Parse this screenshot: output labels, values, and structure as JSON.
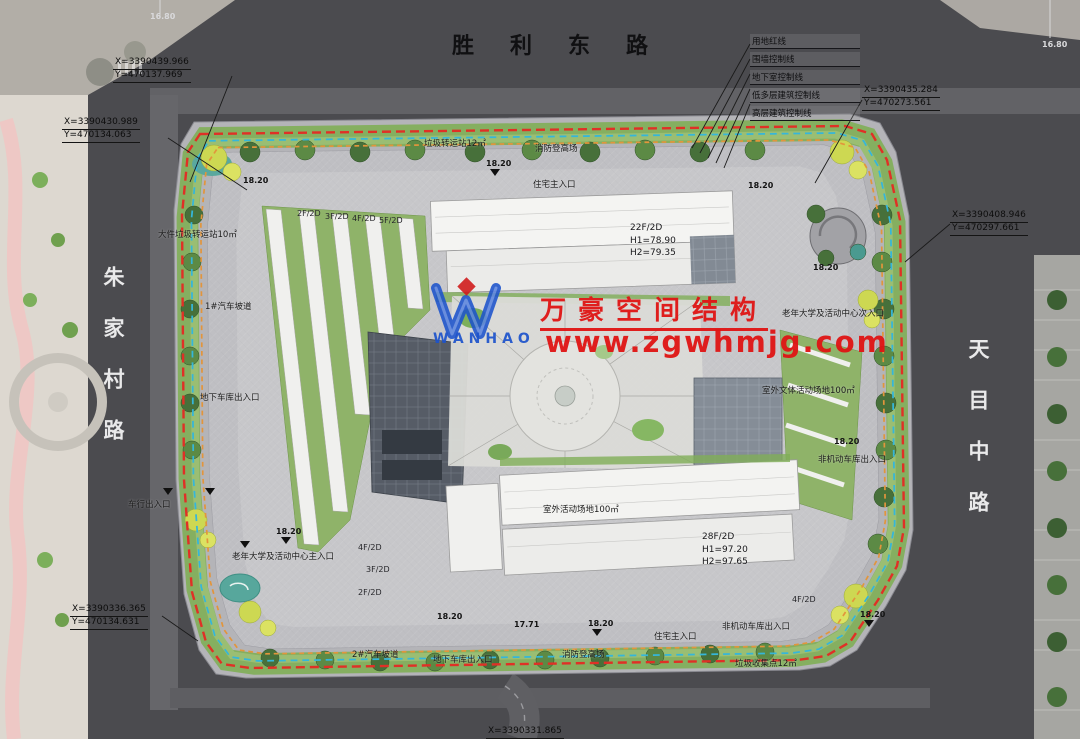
{
  "roads": {
    "top": "胜利东路",
    "left": "朱家村路",
    "right": "天目中路"
  },
  "legend": [
    "用地红线",
    "围墙控制线",
    "地下室控制线",
    "低多层建筑控制线",
    "高层建筑控制线"
  ],
  "coords": [
    {
      "x": "X=3390439.966",
      "y": "Y=470137.969"
    },
    {
      "x": "X=3390430.989",
      "y": "Y=470134.063"
    },
    {
      "x": "X=3390435.284",
      "y": "Y=470273.561"
    },
    {
      "x": "X=3390408.946",
      "y": "Y=470297.661"
    },
    {
      "x": "X=3390336.365",
      "y": "Y=470134.631"
    },
    {
      "x": "X=3390331.865",
      "y": ""
    }
  ],
  "buildings": {
    "tower22": {
      "floors": "22F/2D",
      "h1": "H1=78.90",
      "h2": "H2=79.35"
    },
    "tower28": {
      "floors": "28F/2D",
      "h1": "H1=97.20",
      "h2": "H2=97.65"
    }
  },
  "floor_labels": [
    "2F/2D",
    "3F/2D",
    "4F/2D",
    "5F/2D",
    "4F/2D",
    "3F/2D",
    "2F/2D",
    "4F/2D"
  ],
  "site_labels": [
    "垃圾转运站12㎡",
    "消防登高场",
    "住宅主入口",
    "大件垃圾转运站10㎡",
    "1#汽车坡道",
    "地下车库出入口",
    "车行出入口",
    "老年大学及活动中心主入口",
    "2#汽车坡道",
    "地下车库出入口",
    "消防登高场",
    "住宅主入口",
    "非机动车库出入口",
    "垃圾收集点12㎡",
    "老年大学及活动中心次入口",
    "非机动车库出入口",
    "室外文体活动场地100㎡",
    "室外活动场地100㎡"
  ],
  "elevations": [
    "16.80",
    "18.20",
    "18.20",
    "18.20",
    "18.20",
    "18.20",
    "17.71",
    "18.20",
    "18.20",
    "18.20",
    "16.80",
    "18.20"
  ],
  "watermark": {
    "cn": "万豪空间结构",
    "url": "www.zgwhmjg.com",
    "logo": "WANHAO"
  },
  "colors": {
    "boundary_red": "#e03026",
    "underground_cyan": "#35b6da",
    "building_control_orange": "#e2953c",
    "road_gray": "#4b4b4f",
    "green_belt": "#7fae57",
    "watermark_red": "#e01414",
    "watermark_blue": "#1d53cc"
  }
}
